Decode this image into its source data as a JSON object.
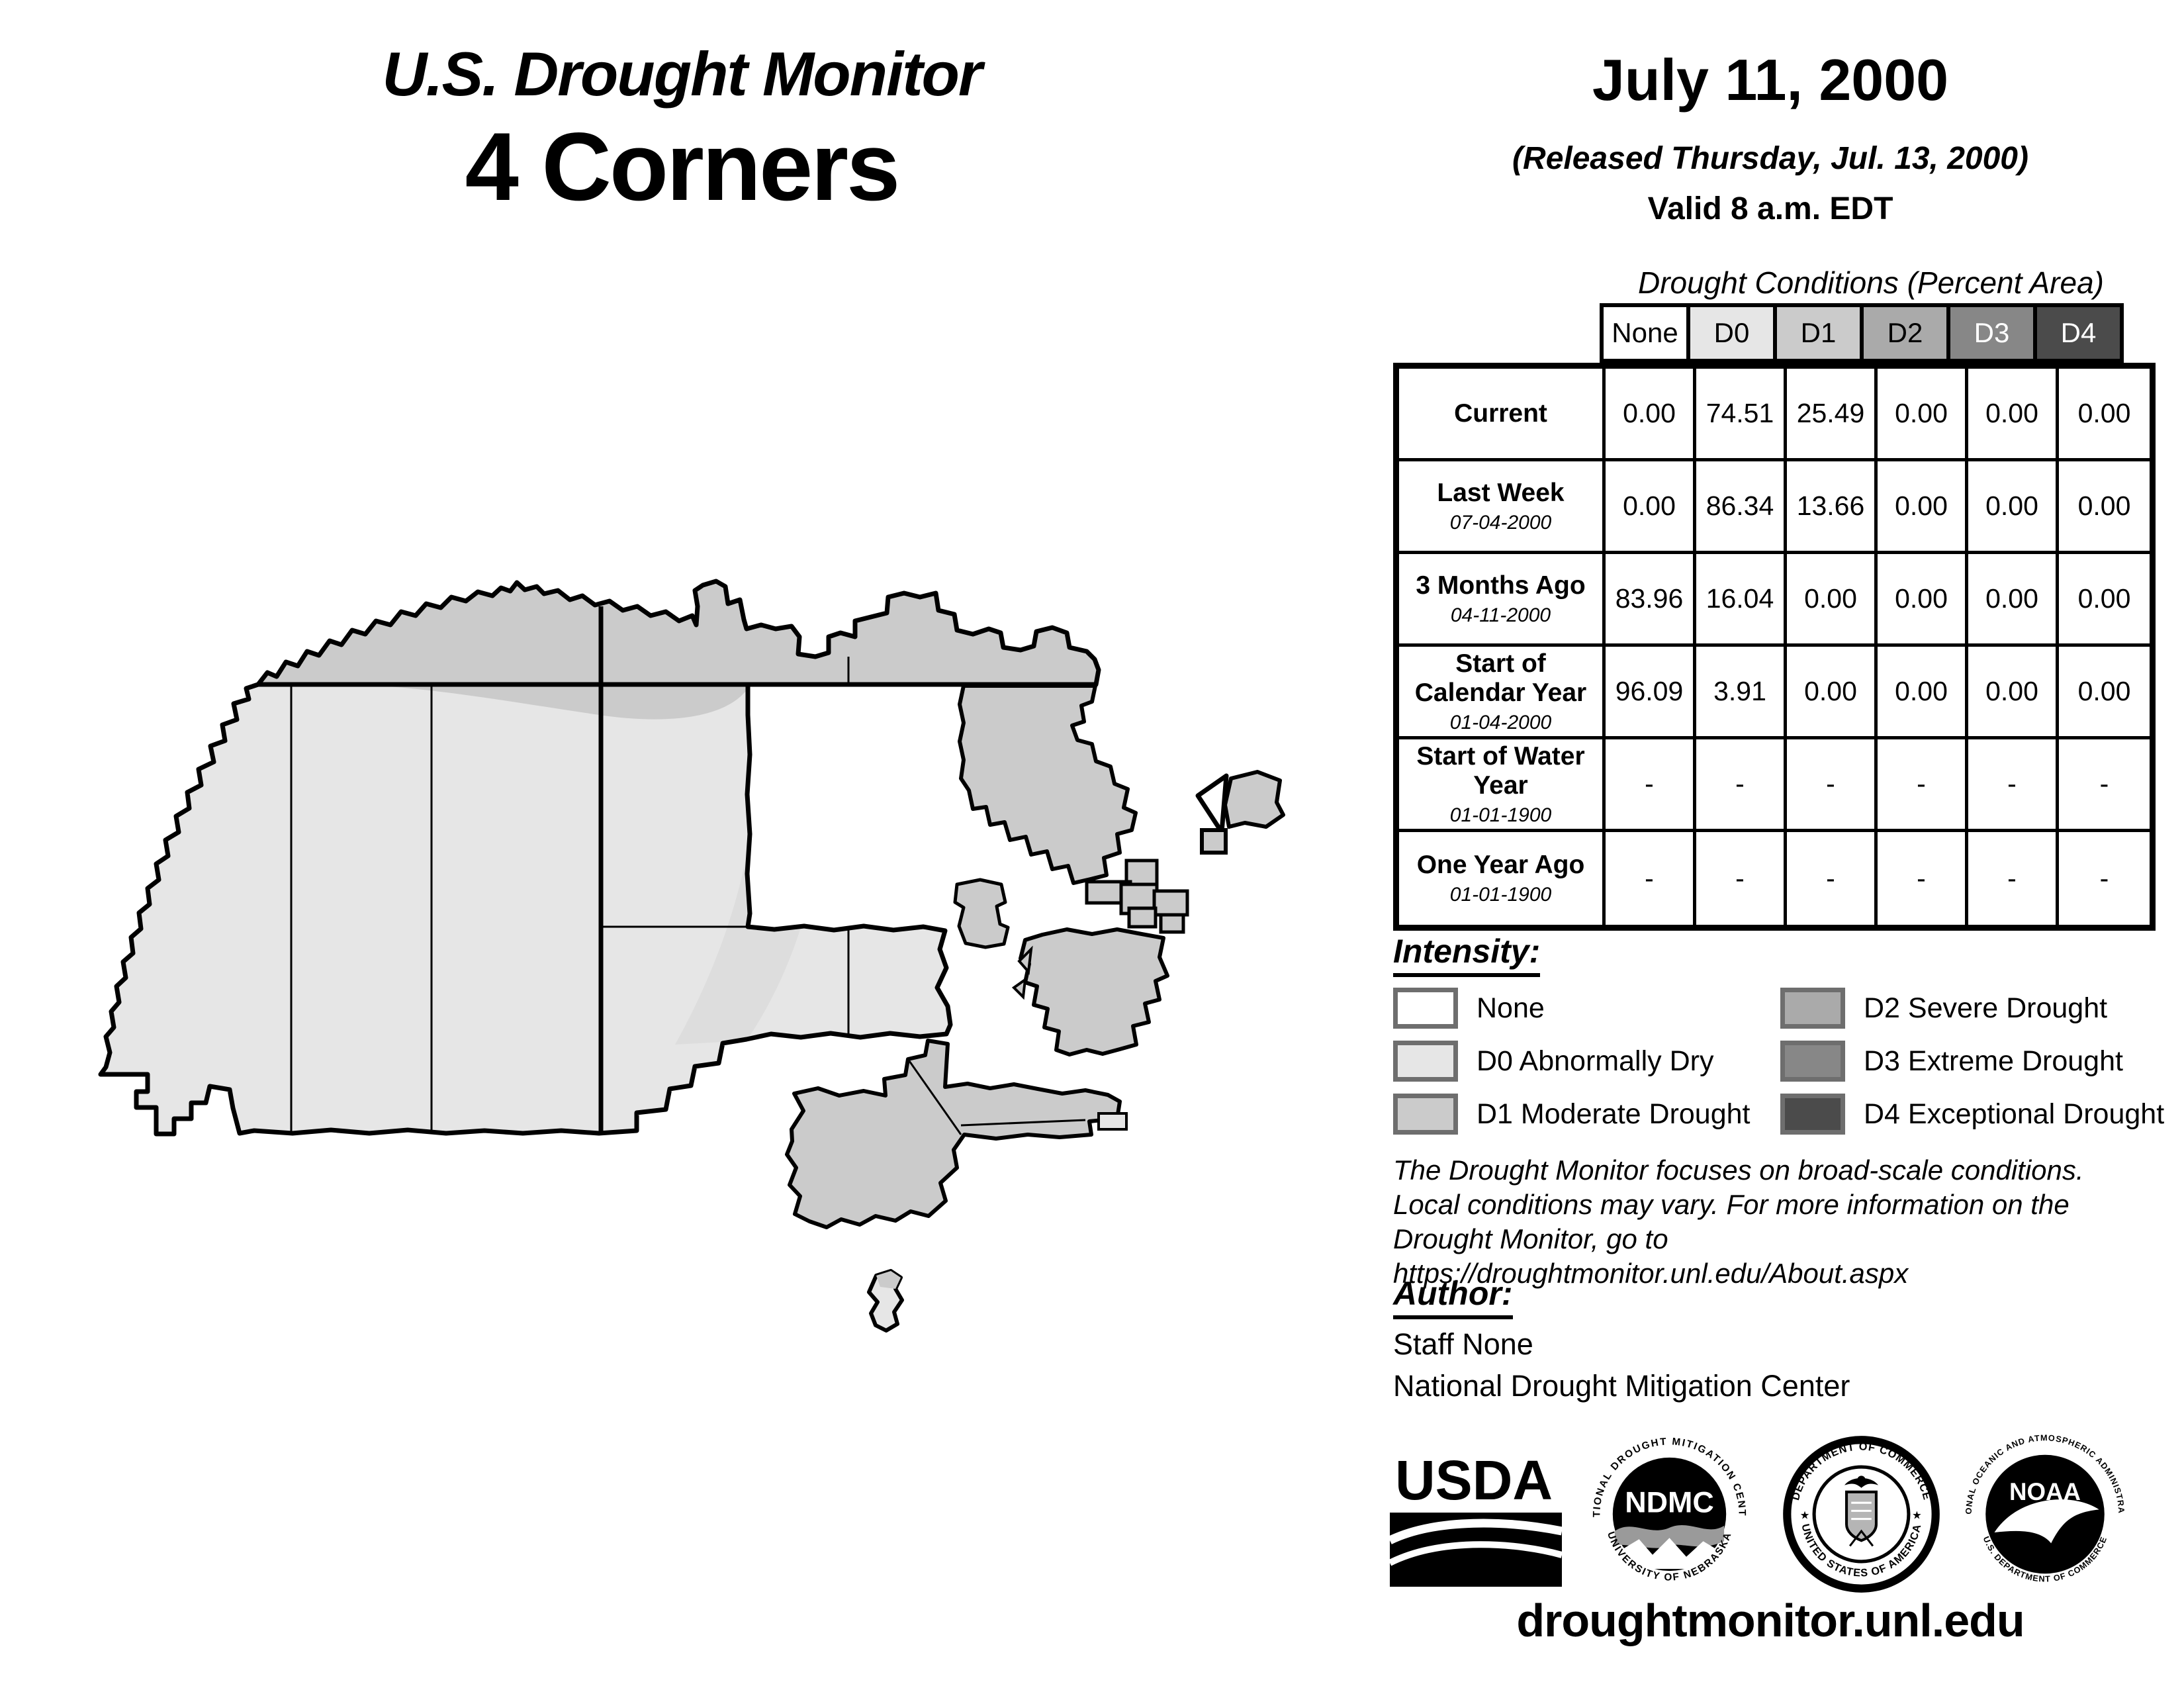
{
  "map_panel": {
    "title_line1": "U.S. Drought Monitor",
    "title_line2": "4 Corners"
  },
  "header": {
    "date": "July 11, 2000",
    "released": "(Released Thursday, Jul. 13, 2000)",
    "valid": "Valid 8 a.m. EDT"
  },
  "table": {
    "title": "Drought Conditions (Percent Area)",
    "columns": [
      "None",
      "D0",
      "D1",
      "D2",
      "D3",
      "D4"
    ],
    "rows": [
      {
        "label": "Current",
        "date": "",
        "values": [
          "0.00",
          "74.51",
          "25.49",
          "0.00",
          "0.00",
          "0.00"
        ]
      },
      {
        "label": "Last Week",
        "date": "07-04-2000",
        "values": [
          "0.00",
          "86.34",
          "13.66",
          "0.00",
          "0.00",
          "0.00"
        ]
      },
      {
        "label": "3 Months Ago",
        "date": "04-11-2000",
        "values": [
          "83.96",
          "16.04",
          "0.00",
          "0.00",
          "0.00",
          "0.00"
        ]
      },
      {
        "label": "Start of Calendar Year",
        "date": "01-04-2000",
        "values": [
          "96.09",
          "3.91",
          "0.00",
          "0.00",
          "0.00",
          "0.00"
        ]
      },
      {
        "label": "Start of Water Year",
        "date": "01-01-1900",
        "values": [
          "-",
          "-",
          "-",
          "-",
          "-",
          "-"
        ]
      },
      {
        "label": "One Year Ago",
        "date": "01-01-1900",
        "values": [
          "-",
          "-",
          "-",
          "-",
          "-",
          "-"
        ]
      }
    ]
  },
  "legend": {
    "title": "Intensity:",
    "items": [
      {
        "label": "None",
        "color": "#ffffff"
      },
      {
        "label": "D0 Abnormally Dry",
        "color": "#e6e6e6"
      },
      {
        "label": "D1 Moderate Drought",
        "color": "#cbcbcb"
      },
      {
        "label": "D2 Severe Drought",
        "color": "#aaaaaa"
      },
      {
        "label": "D3 Extreme Drought",
        "color": "#878787"
      },
      {
        "label": "D4 Exceptional Drought",
        "color": "#4b4b4b"
      }
    ]
  },
  "disclaimer": {
    "line1": "The Drought Monitor focuses on broad-scale conditions.",
    "line2": "Local conditions may vary. For more information on the",
    "line3": "Drought Monitor, go to https://droughtmonitor.unl.edu/About.aspx"
  },
  "author": {
    "title": "Author:",
    "name": "Staff None",
    "org": "National Drought Mitigation Center"
  },
  "logos": {
    "usda": "USDA",
    "ndmc": "NDMC",
    "ndmc_arc_top": "NATIONAL DROUGHT MITIGATION CENTER",
    "ndmc_arc_bottom": "UNIVERSITY OF NEBRASKA",
    "doc_arc_top": "DEPARTMENT OF COMMERCE",
    "doc_arc_bottom": "UNITED STATES OF AMERICA",
    "noaa": "NOAA",
    "noaa_arc_top": "NATIONAL OCEANIC AND ATMOSPHERIC ADMINISTRATION",
    "noaa_arc_bottom": "U.S. DEPARTMENT OF COMMERCE"
  },
  "footer": {
    "website": "droughtmonitor.unl.edu"
  },
  "colors": {
    "none": "#ffffff",
    "d0": "#e6e6e6",
    "d1": "#cbcbcb",
    "d2": "#aaaaaa",
    "d3": "#878787",
    "d4": "#4b4b4b"
  }
}
